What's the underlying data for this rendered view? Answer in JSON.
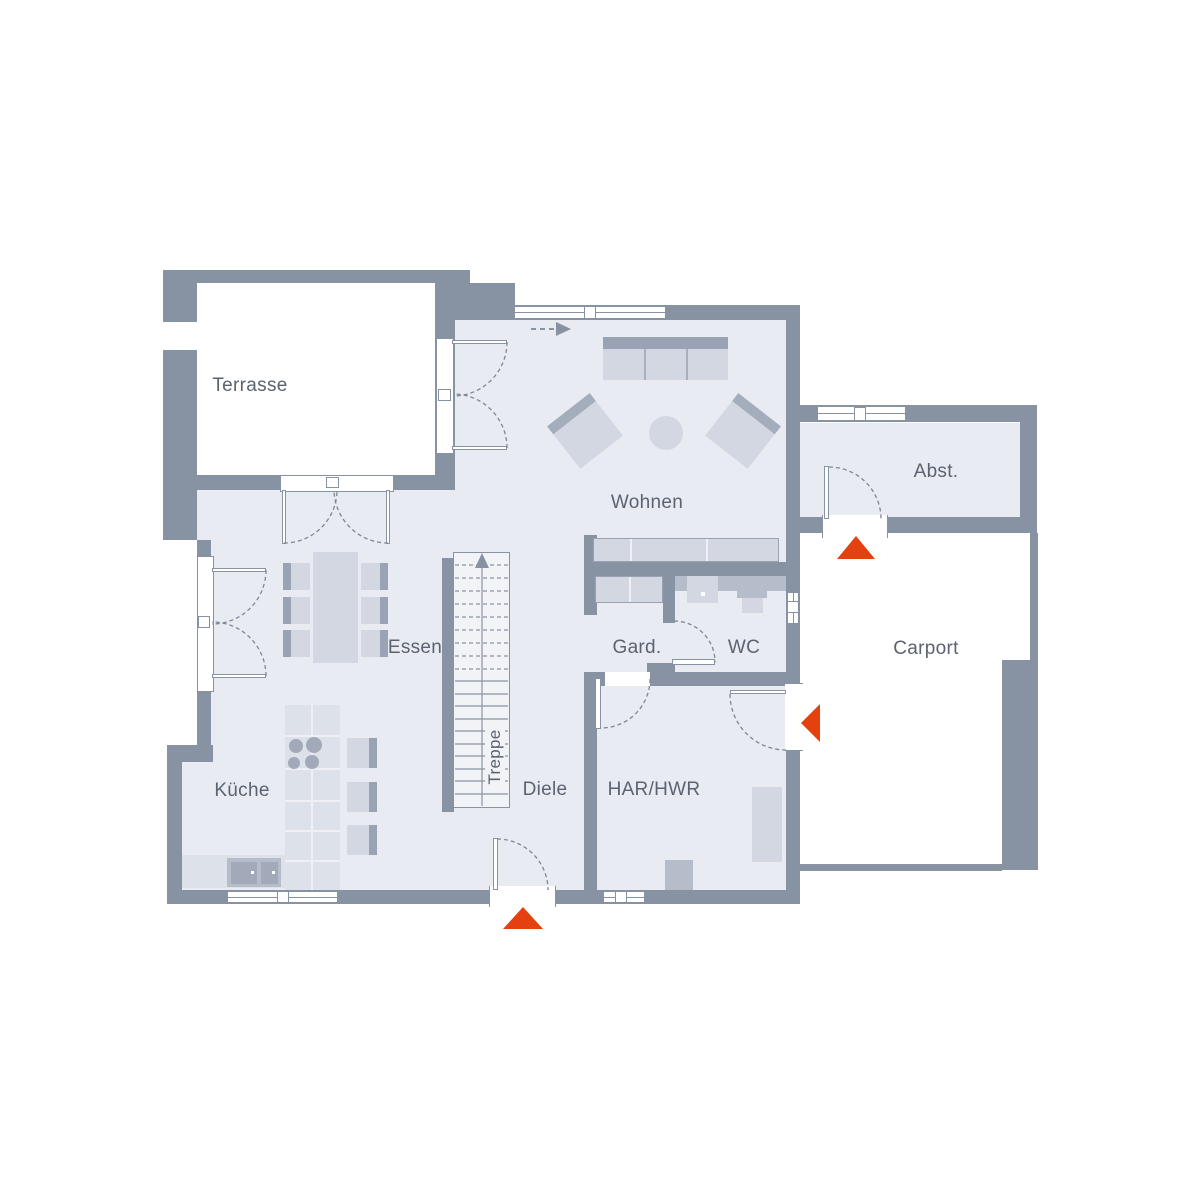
{
  "rooms": [
    {
      "id": "terrasse",
      "label": "Terrasse"
    },
    {
      "id": "wohnen",
      "label": "Wohnen"
    },
    {
      "id": "abstellraum",
      "label": "Abst."
    },
    {
      "id": "carport",
      "label": "Carport"
    },
    {
      "id": "essen",
      "label": "Essen"
    },
    {
      "id": "garderobe",
      "label": "Gard."
    },
    {
      "id": "wc",
      "label": "WC"
    },
    {
      "id": "treppe",
      "label": "Treppe"
    },
    {
      "id": "diele",
      "label": "Diele"
    },
    {
      "id": "har_hwr",
      "label": "HAR/HWR"
    },
    {
      "id": "kueche",
      "label": "Küche"
    }
  ],
  "arrows": [
    {
      "id": "entrance-carport-to-abst",
      "direction": "up"
    },
    {
      "id": "entrance-carport-to-har",
      "direction": "left"
    },
    {
      "id": "main-entrance",
      "direction": "up"
    }
  ],
  "colors": {
    "wall": "#8792a2",
    "floor": "#e8ebf1",
    "furniture_light": "#d2d7e1",
    "furniture_medium": "#b6bdca",
    "furniture_dark": "#9aa3b4",
    "accent_red": "#e5400f",
    "text": "#5b6370",
    "background": "#ffffff"
  }
}
